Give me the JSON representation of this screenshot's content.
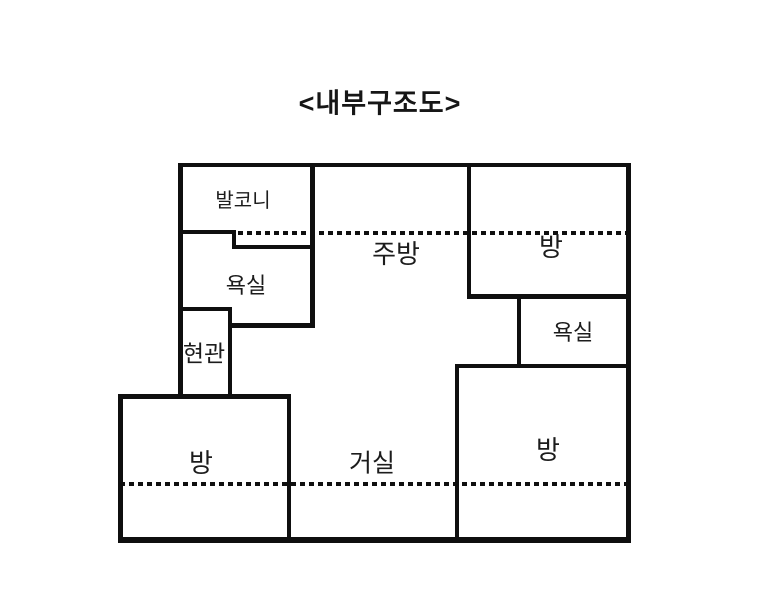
{
  "title": "<내부구조도>",
  "rooms": {
    "balcony": "발코니",
    "bathroom_left": "욕실",
    "entrance": "현관",
    "kitchen": "주방",
    "room_top_right": "방",
    "bathroom_right": "욕실",
    "room_bottom_left": "방",
    "living_room": "거실",
    "room_bottom_right": "방"
  },
  "colors": {
    "background": "#ffffff",
    "wall": "#0f0f0f",
    "text": "#1c1c1c"
  }
}
